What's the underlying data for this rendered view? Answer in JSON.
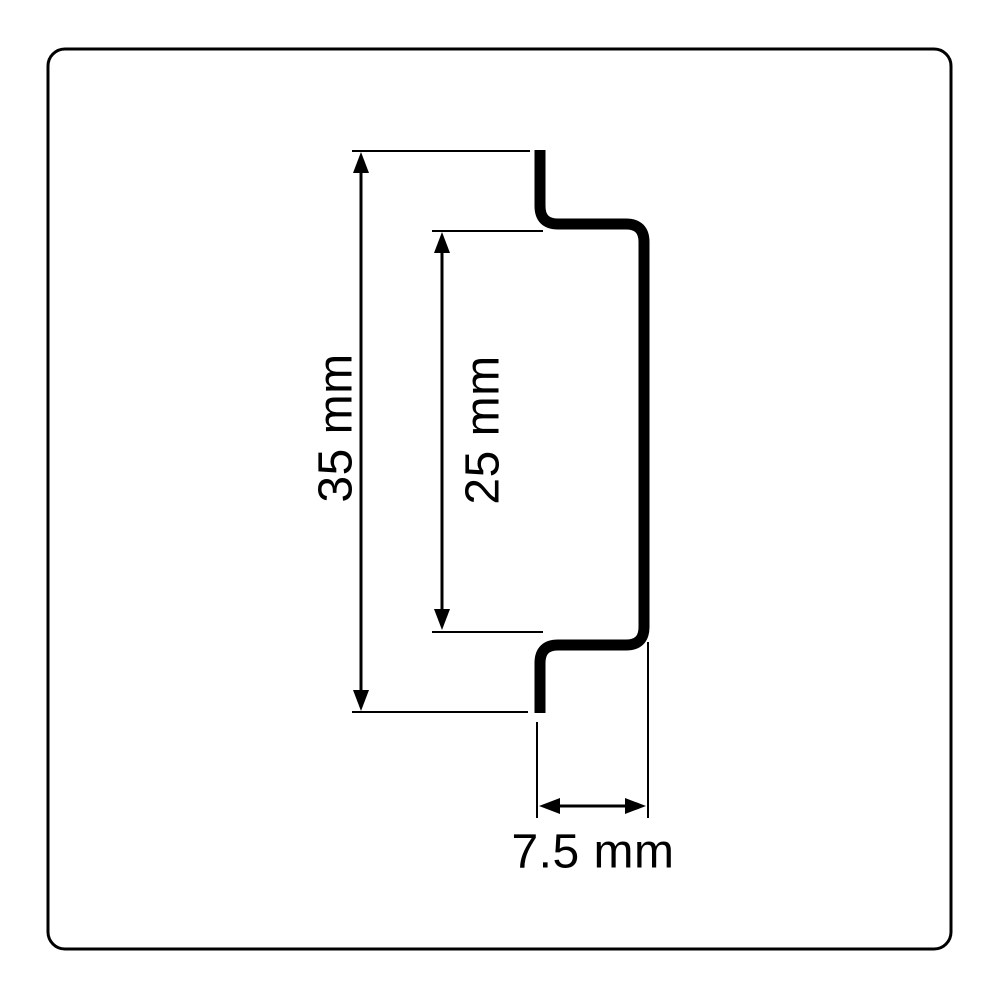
{
  "drawing": {
    "kind": "technical-dimension-drawing",
    "subject": "din-rail-top-hat-profile-cross-section",
    "colors": {
      "background": "#ffffff",
      "line": "#000000"
    },
    "dimensions": {
      "overall_height": {
        "label": "35 mm",
        "orientation": "vertical"
      },
      "inner_height": {
        "label": "25 mm",
        "orientation": "vertical"
      },
      "depth": {
        "label": "7.5 mm",
        "orientation": "horizontal"
      }
    }
  }
}
